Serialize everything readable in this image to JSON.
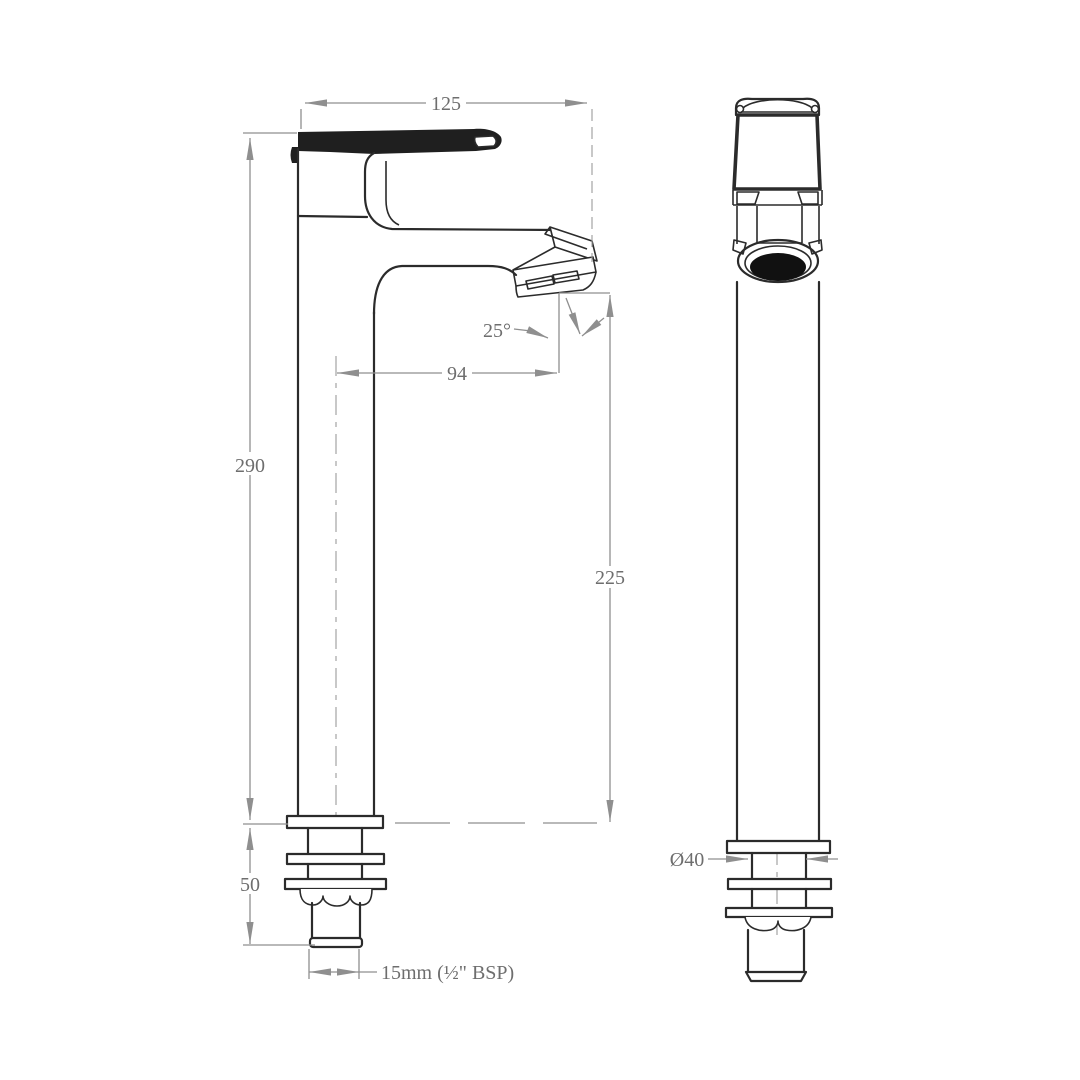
{
  "drawing": {
    "type": "technical-drawing",
    "subject": "tall basin mixer tap - side elevation and front elevation with dimensions",
    "views": [
      {
        "id": "side-view"
      },
      {
        "id": "front-view"
      }
    ],
    "dimensions": {
      "overall_width": "125",
      "body_height": "290",
      "spout_reach": "94",
      "spout_height": "225",
      "spout_angle": "25°",
      "mounting_depth": "50",
      "thread_size": "15mm (½\" BSP)",
      "base_diameter": "Ø40"
    },
    "colors": {
      "object_line": "#2b2b2b",
      "dimension_line": "#8f8f8f",
      "dimension_text": "#6e6e6e",
      "aerator_fill": "#111111",
      "background": "#ffffff"
    }
  }
}
